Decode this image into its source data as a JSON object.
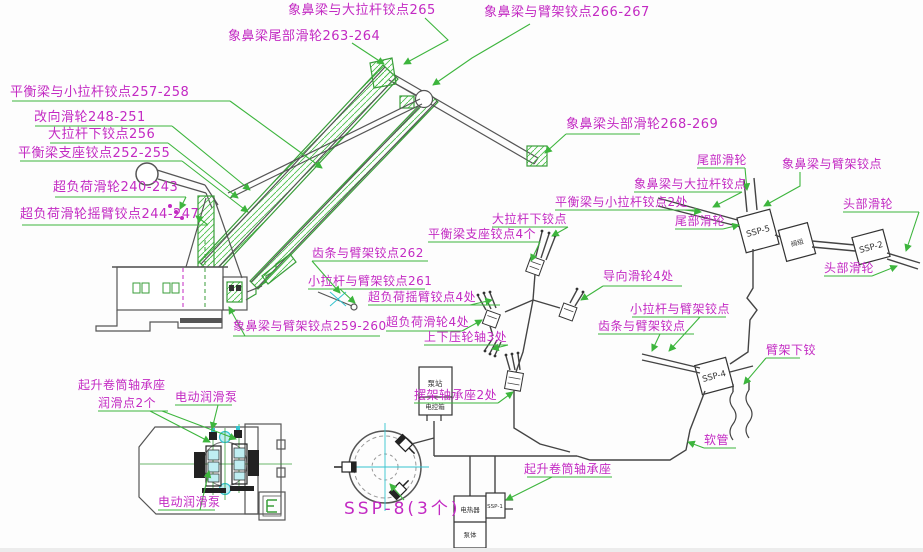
{
  "title": "门座起重机集中润滑点布置图",
  "colors": {
    "label_magenta": "#c32ac3",
    "leader_green": "#3db53d",
    "drawing_line": "#4a4a4a",
    "cyan": "#35c4cf"
  },
  "labels": {
    "jaw_bigtie_265": "象鼻梁与大拉杆铰点265",
    "jaw_tail_263_264": "象鼻梁尾部滑轮263-264",
    "jaw_boom_266_267": "象鼻梁与臂架铰点266-267",
    "bal_smalltie_257_258": "平衡梁与小拉杆铰点257-258",
    "divert_248_251": "改向滑轮248-251",
    "bigtie_lower_256": "大拉杆下铰点256",
    "bal_support_252_255": "平衡梁支座铰点252-255",
    "overload_240_243": "超负荷滑轮240-243",
    "overload_arm_244_247": "超负荷滑轮摇臂铰点244-247",
    "jaw_head_268_269": "象鼻梁头部滑轮268-269",
    "rack_boom_262": "齿条与臂架铰点262",
    "smalltie_boom_261": "小拉杆与臂架铰点261",
    "overload_arm_4": "超负荷摇臂铰点4处",
    "jaw_boom_259_260": "象鼻梁与臂架铰点259-260",
    "overload_4": "超负荷滑轮4处",
    "updown_roller_3": "上下压轮轴3处",
    "bal_support_4": "平衡梁支座铰点4个",
    "bigtie_lower2": "大拉杆下铰点",
    "bal_smalltie_2": "平衡梁与小拉杆铰点2处",
    "guide_4": "导向滑轮4处",
    "smalltie_boom2": "小拉杆与臂架铰点",
    "rack_boom2": "齿条与臂架铰点",
    "tail_sheave_a": "尾部滑轮",
    "jaw_bigtie2": "象鼻梁与大拉杆铰点",
    "jaw_boom2": "象鼻梁与臂架铰点",
    "tail_sheave_b": "尾部滑轮",
    "head_sheave_a": "头部滑轮",
    "head_sheave_b": "头部滑轮",
    "boom_lower_hinge": "臂架下铰",
    "hose": "软管",
    "rocker_bearing_2": "摆架轴承座2处",
    "drum_bearing_left": "起升卷筒轴承座",
    "lube_points_2": "润滑点2个",
    "motor_pump_a": "电动润滑泵",
    "motor_pump_b": "电动润滑泵",
    "drum_bearing_right": "起升卷筒轴承座",
    "ssp8_caption": "SSP-8(3个)"
  },
  "boxes": {
    "ssp5": "SSP-5",
    "ssp2": "SSP-2",
    "ssp4": "SSP-4",
    "ssp1": "SSP-1",
    "inline_valve": "阀组",
    "pump_station": "泵站",
    "control_box": "电控箱",
    "heater": "电热器",
    "pump_body": "泵体"
  }
}
